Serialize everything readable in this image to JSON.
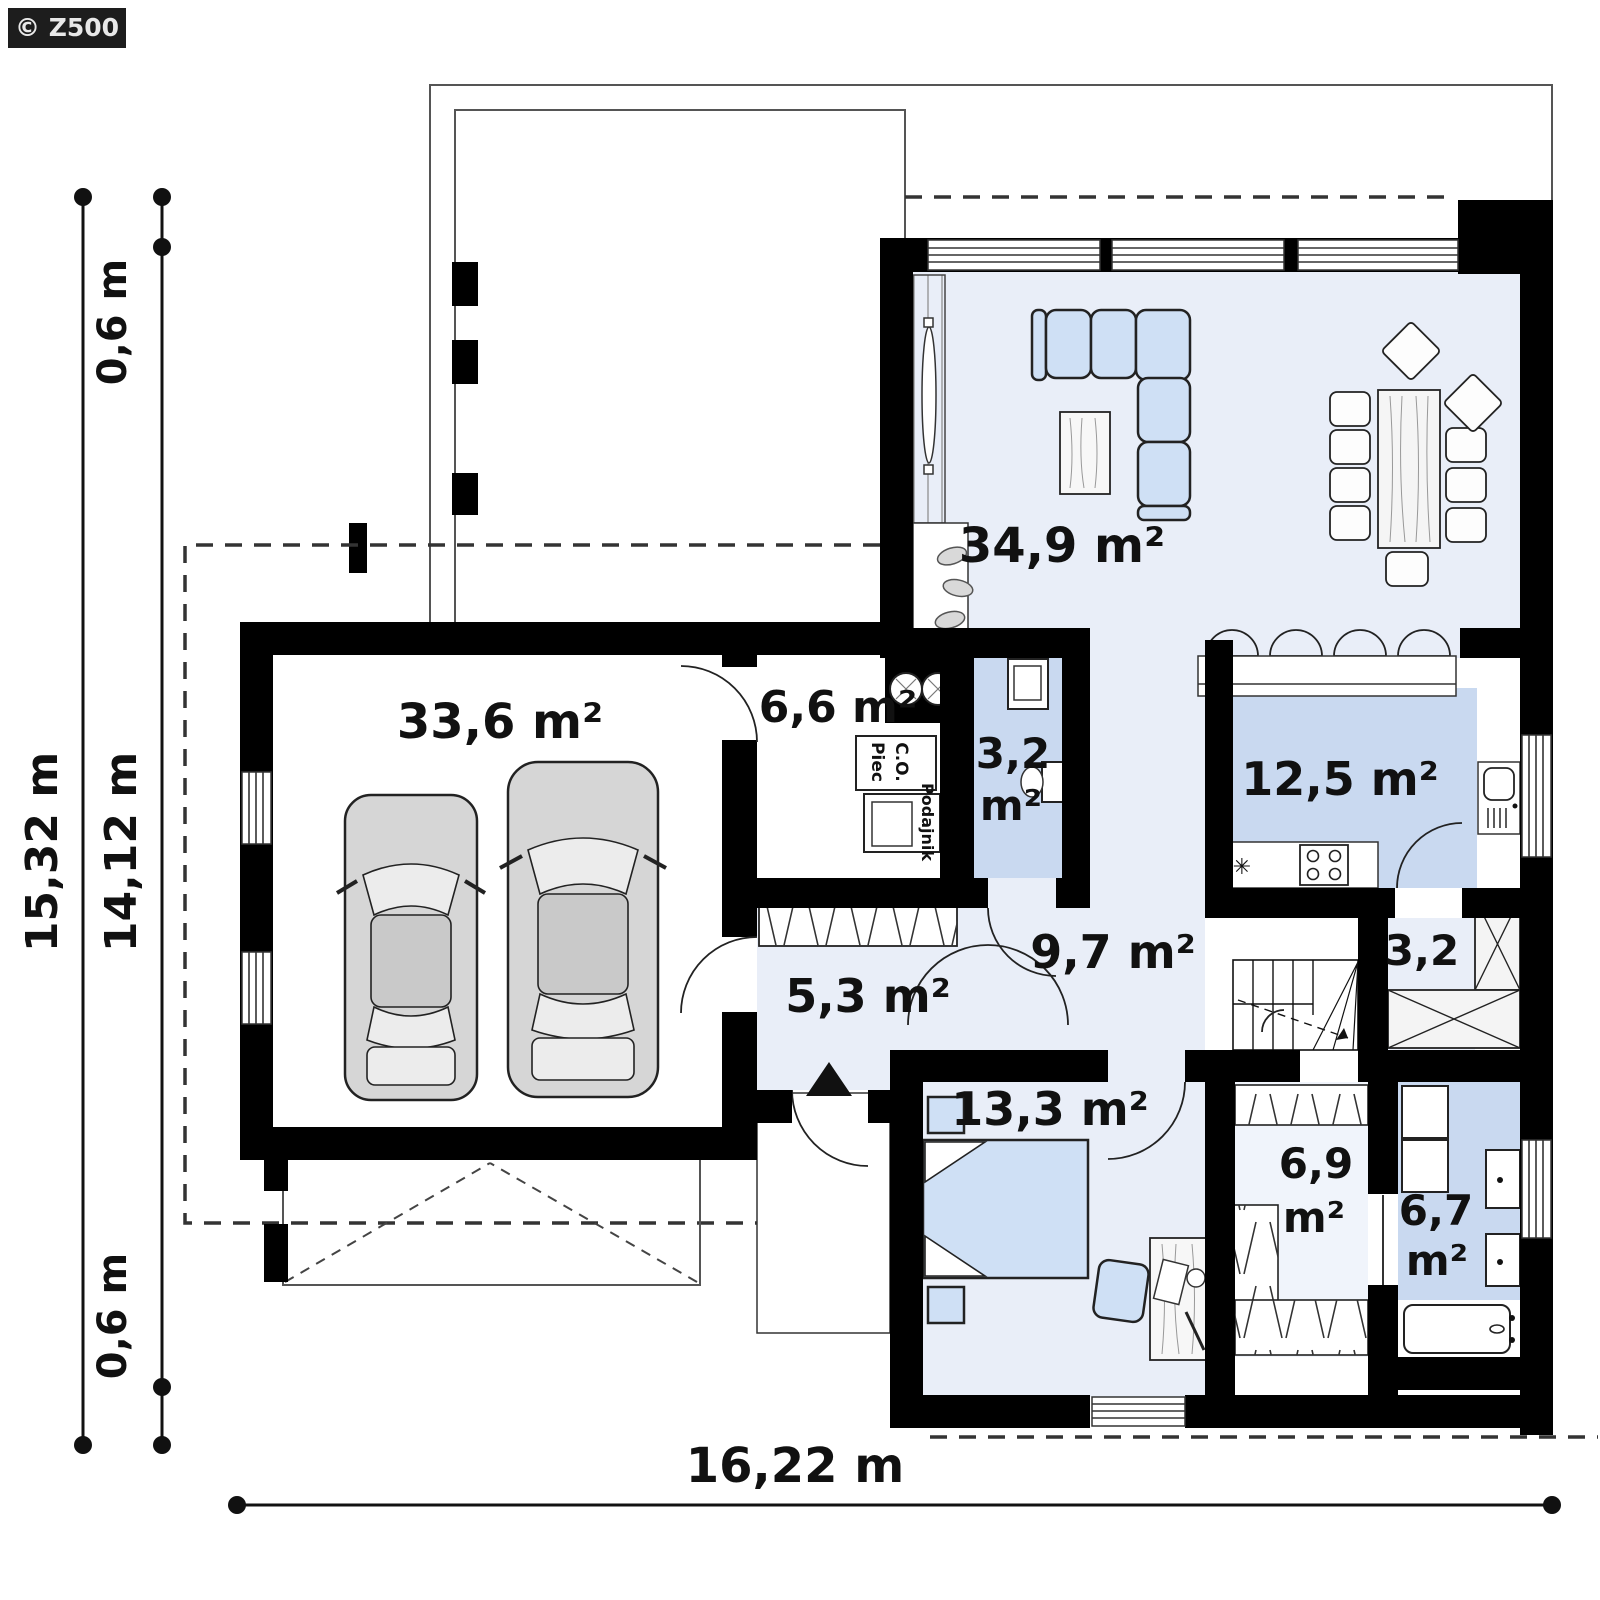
{
  "watermark": "© Z500",
  "colors": {
    "wall": "#000000",
    "floor_light": "#e9eef8",
    "floor_blue": "#c9d9f0",
    "floor_pale": "#f0f4fb",
    "furniture_blue": "#cfe0f5",
    "car_gray": "#d6d6d6"
  },
  "rooms": {
    "living": {
      "label": "34,9 m²"
    },
    "garage": {
      "label": "33,6 m²"
    },
    "boiler": {
      "label": "6,6 m²"
    },
    "wc": {
      "value": "3,2",
      "unit": "m²"
    },
    "kitchen": {
      "label": "12,5 m²"
    },
    "pantry": {
      "label": "3,2"
    },
    "hall": {
      "label": "9,7 m²"
    },
    "entry": {
      "label": "5,3 m²"
    },
    "bedroom": {
      "label": "13,3 m²"
    },
    "wardrobe": {
      "value": "6,9",
      "unit": "m²"
    },
    "bathroom": {
      "value": "6,7",
      "unit": "m²"
    }
  },
  "equipment": {
    "boiler_line1": "Piec",
    "boiler_line2": "C.O.",
    "feeder": "Podajnik",
    "dishwasher_mark": "✳"
  },
  "dimensions": {
    "total_height": "15,32 m",
    "inner_height": "14,12 m",
    "offset_top": "0,6 m",
    "offset_bottom": "0,6 m",
    "total_width": "16,22 m"
  }
}
